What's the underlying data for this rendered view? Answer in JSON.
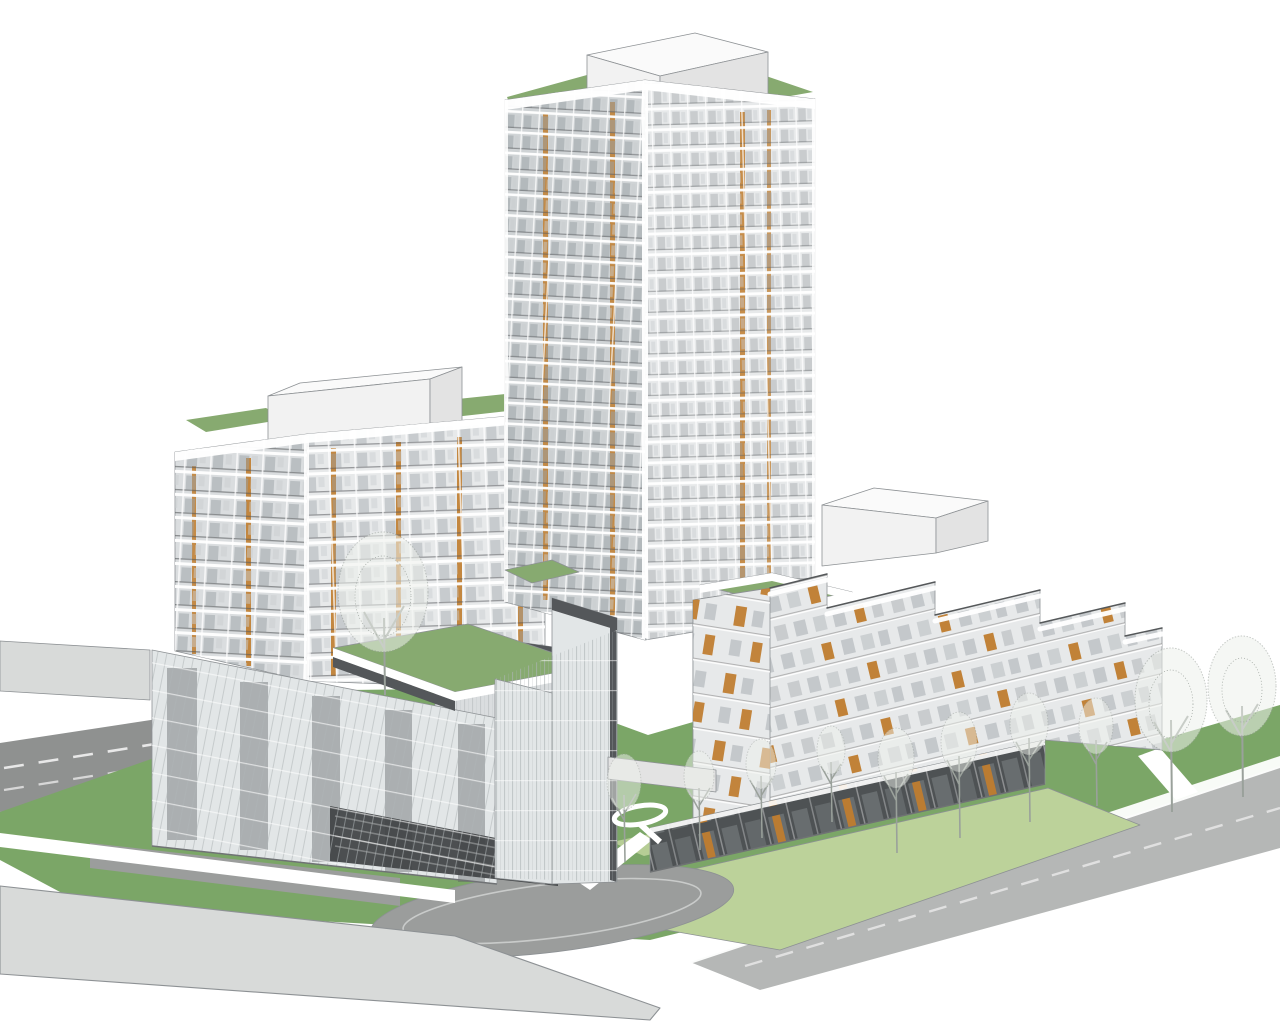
{
  "meta": {
    "description": "White axonometric architectural massing rendering of a three-building residential development: a central high-rise tower, a west mid-rise block and an east terraced mid-rise on a shared glass podium, with green roofs, lawns, streets, a drop-off loop, white pedestrian paths and bare deciduous trees",
    "render_style": "monochrome architectural line render with green landscaping and orange facade accents"
  },
  "buildings": {
    "west_midrise": {
      "label": "West mid-rise block",
      "visible_storeys": 10,
      "roof": [
        "green roof",
        "rooftop mechanical penthouse"
      ],
      "facade": "gridded glazing with balconies and orange vertical accent strips"
    },
    "central_tower": {
      "label": "Central high-rise tower",
      "visible_storeys": 26,
      "roof": [
        "green roof",
        "rooftop mechanical penthouse"
      ],
      "facade": "white floor-grid glazing with balconies and orange vertical accent strips"
    },
    "podium": {
      "label": "Glass podium",
      "features": [
        "green roof terrace",
        "glass atrium volume",
        "dark spandrel fascia",
        "parking garage entry",
        "drop-off arrival court"
      ]
    },
    "east_terraced": {
      "label": "East terraced mid-rise",
      "visible_storeys": 9,
      "features": [
        "stepped balcony terraces with railings",
        "orange accent doors",
        "dark ground-floor storefronts",
        "green roof at west end",
        "rooftop mechanical penthouse"
      ]
    }
  },
  "site": {
    "north_street": {
      "label": "North street",
      "markings": "dashed white lane lines"
    },
    "east_street": {
      "label": "East street",
      "markings": "dashed centre line, white kerb strip"
    },
    "west_road": {
      "label": "West road stub"
    },
    "sidewalk": {
      "label": "South sidewalk band"
    },
    "driveway": {
      "label": "Drop-off loop driveway"
    },
    "paths": {
      "label": "White pedestrian paths"
    },
    "lawns": {
      "label": "Lawns and planted verges"
    },
    "trees": {
      "label": "Bare deciduous trees",
      "count": 12
    }
  },
  "colors": {
    "bg": "#ffffff",
    "facade-light": "#e7e9ea",
    "facade-mid": "#dadddf",
    "facade-dim": "#cfd3d5",
    "panel-dark": "#54575a",
    "glass-tint": "#e2e6e7",
    "window-glass": "#9aa1a6",
    "window-glass-light": "#c9cdd0",
    "glass-mullion": "#aeb4b6",
    "storefront-glass": "#7d8285",
    "mullion-white": "#ffffff",
    "rail-dark": "#55585a",
    "floor-shadow": "#9b9b9b",
    "line-gray": "#8d9194",
    "orange-accent": "#bf7c2e",
    "roof-green": "#87aa70",
    "ground-green": "#7ba667",
    "lawn-green": "#bcd29a",
    "road-dark": "#8f9190",
    "road-light": "#b5b7b6",
    "sidewalk-gray": "#d8dad9",
    "driveway-gray": "#9b9d9c",
    "curb-light": "#c9cbca",
    "mech-front": "#f2f2f2",
    "mech-side": "#e3e3e3",
    "mech-top": "#fafafa",
    "tree-gray": "#9aa19b",
    "tree-fill": "#eef1ec",
    "lane-dash": "#e8e8e8",
    "storefront-dark": "#4e5254"
  }
}
